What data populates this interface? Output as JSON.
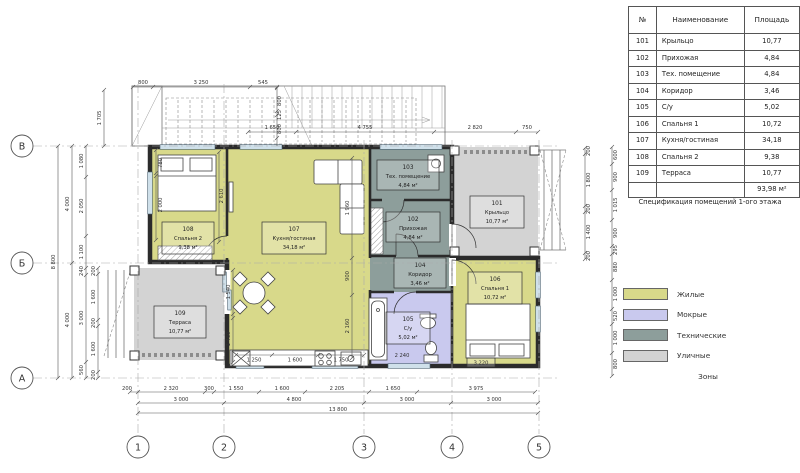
{
  "zones": {
    "living": "#d8d98a",
    "wet": "#c9c9ee",
    "tech": "#8d9e9b",
    "street": "#d3d3d3"
  },
  "plan": {
    "rooms": [
      {
        "number": "101",
        "name": "Крыльцо",
        "area": "10,77 м²",
        "zone": "street"
      },
      {
        "number": "102",
        "name": "Прихожая",
        "area": "4,84 м²",
        "zone": "tech"
      },
      {
        "number": "103",
        "name": "Тех. помещение",
        "area": "4,84 м²",
        "zone": "tech"
      },
      {
        "number": "104",
        "name": "Коридор",
        "area": "3,46 м²",
        "zone": "tech"
      },
      {
        "number": "105",
        "name": "С/у",
        "area": "5,02 м²",
        "zone": "wet"
      },
      {
        "number": "106",
        "name": "Спальня 1",
        "area": "10,72 м²",
        "zone": "living"
      },
      {
        "number": "107",
        "name": "Кухня/гостиная",
        "area": "34,18 м²",
        "zone": "living"
      },
      {
        "number": "108",
        "name": "Спальня 2",
        "area": "9,38 м²",
        "zone": "living"
      },
      {
        "number": "109",
        "name": "Терраса",
        "area": "10,77 м²",
        "zone": "street"
      }
    ],
    "axes": {
      "cols": [
        "1",
        "2",
        "3",
        "4",
        "5"
      ],
      "rows": [
        "В",
        "Б",
        "А"
      ]
    },
    "dims": {
      "stair_top": [
        "800",
        "3 250",
        "545"
      ],
      "stair_left": [
        "1 705"
      ],
      "stair_right": [
        "800",
        "125",
        "800"
      ],
      "top": [
        "1 650",
        "4 755",
        "2 820",
        "750"
      ],
      "bottom_a": [
        "200",
        "2 320",
        "300",
        "1 550",
        "1 600",
        "2 205",
        "1 650",
        "3 975"
      ],
      "bottom_b": [
        "3 000",
        "4 800",
        "3 000",
        "3 000"
      ],
      "bottom_c": [
        "13 800"
      ],
      "left_a": [
        "8 800"
      ],
      "left_b": [
        "4 000",
        "4 000"
      ],
      "left_c": [
        "1 080",
        "2 050",
        "1 100",
        "240",
        "3 000",
        "560"
      ],
      "left_d": [
        "200",
        "1 600",
        "200",
        "1 600",
        "200"
      ],
      "right_a": [
        "200",
        "1 800",
        "200",
        "1 400",
        "200"
      ],
      "right_b": [
        "600",
        "900",
        "1 015",
        "900",
        "295",
        "880",
        "1 000",
        "520",
        "1 000",
        "800"
      ],
      "interior": [
        "1 960",
        "900",
        "2 160",
        "1 540",
        "1 460",
        "1 250",
        "1 600",
        "1 750",
        "780",
        "2 000",
        "2 610",
        "3 220",
        "2 240"
      ]
    }
  },
  "table": {
    "headers": {
      "num": "№",
      "name": "Наименование",
      "area": "Площадь"
    },
    "rows": [
      {
        "num": "101",
        "name": "Крыльцо",
        "area": "10,77"
      },
      {
        "num": "102",
        "name": "Прихожая",
        "area": "4,84"
      },
      {
        "num": "103",
        "name": "Тех. помещение",
        "area": "4,84"
      },
      {
        "num": "104",
        "name": "Коридор",
        "area": "3,46"
      },
      {
        "num": "105",
        "name": "С/у",
        "area": "5,02"
      },
      {
        "num": "106",
        "name": "Спальня 1",
        "area": "10,72"
      },
      {
        "num": "107",
        "name": "Кухня/гостиная",
        "area": "34,18"
      },
      {
        "num": "108",
        "name": "Спальня 2",
        "area": "9,38"
      },
      {
        "num": "109",
        "name": "Терраса",
        "area": "10,77"
      }
    ],
    "total": "93,98 м²",
    "caption": "Спецификация помещений 1-ого этажа"
  },
  "legend": {
    "items": [
      {
        "label": "Жилые",
        "zone": "living"
      },
      {
        "label": "Мокрые",
        "zone": "wet"
      },
      {
        "label": "Технические",
        "zone": "tech"
      },
      {
        "label": "Уличные",
        "zone": "street"
      }
    ],
    "caption": "Зоны"
  }
}
